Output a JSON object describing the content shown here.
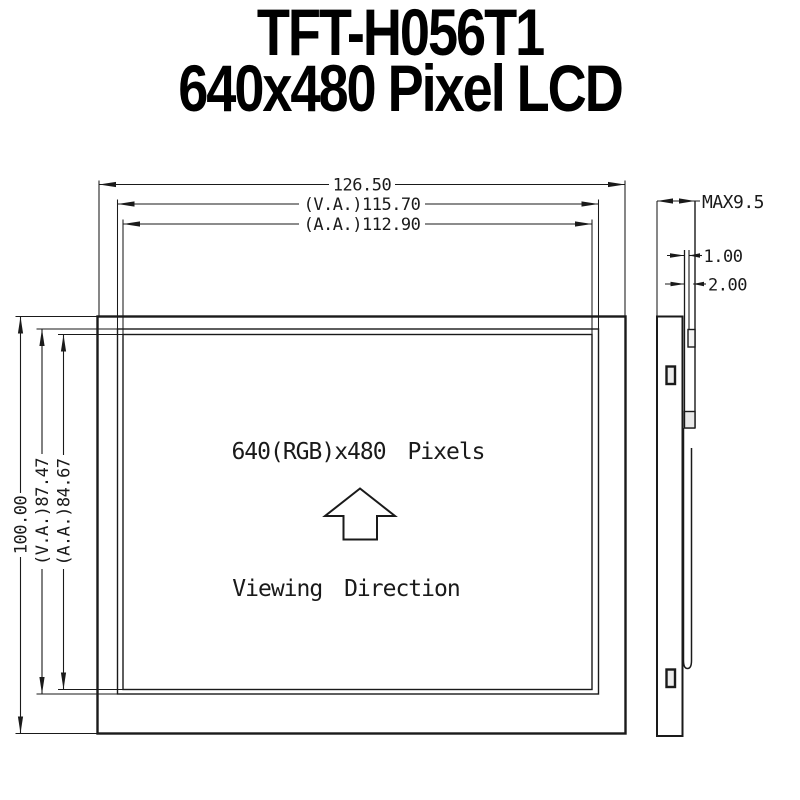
{
  "page": {
    "background": "#ffffff",
    "ink": "#1a1a1a"
  },
  "title": {
    "line1": "TFT-H056T1",
    "line2": "640x480 Pixel LCD"
  },
  "front_view": {
    "dim_width_overall": "126.50",
    "dim_width_viewing_area": "(V.A.)115.70",
    "dim_width_active_area": "(A.A.)112.90",
    "dim_height_overall": "100.00",
    "dim_height_viewing_area": "(V.A.)87.47",
    "dim_height_active_area": "(A.A.)84.67",
    "pixel_label": "640(RGB)x480  Pixels",
    "viewing_direction_label": "Viewing Direction"
  },
  "side_view": {
    "dim_thickness_max": "MAX9.5",
    "dim_front_glass": "1.00",
    "dim_panel": "2.00"
  }
}
